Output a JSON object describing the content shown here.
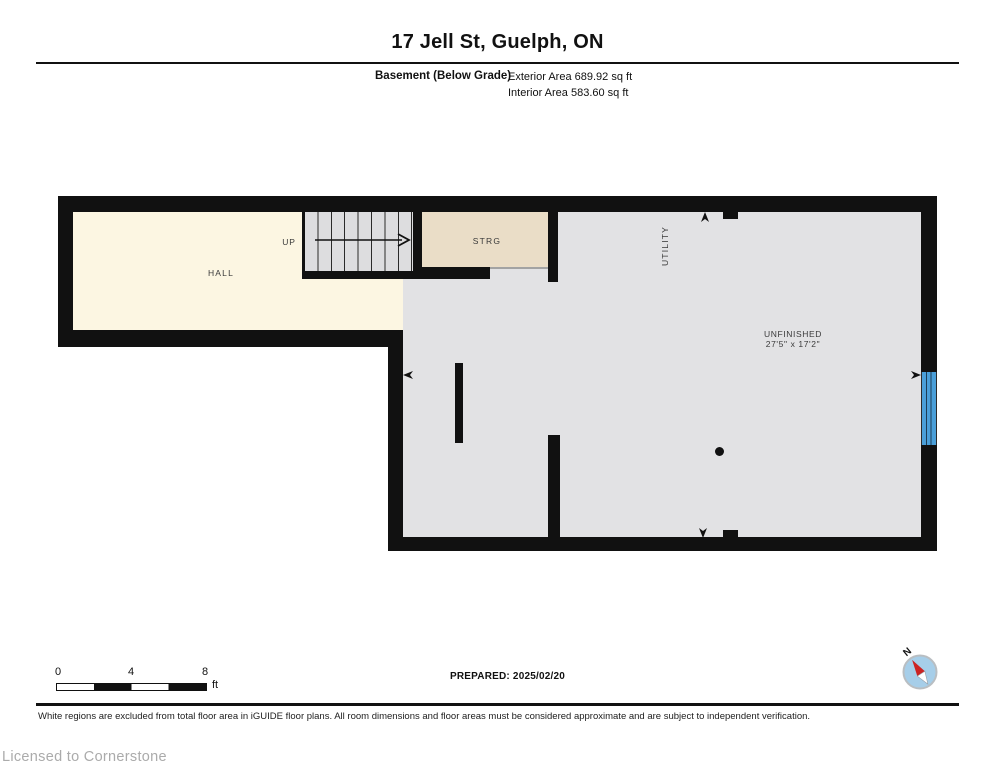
{
  "header": {
    "title": "17 Jell St, Guelph, ON",
    "floor_label": "Basement (Below Grade)",
    "exterior_area": "Exterior Area 689.92 sq ft",
    "interior_area": "Interior Area 583.60 sq ft"
  },
  "plan": {
    "rooms": {
      "hall": "HALL",
      "stairs_direction": "UP",
      "storage": "STRG",
      "utility": "UTILITY",
      "unfinished_name": "UNFINISHED",
      "unfinished_dims": "27'5\" x 17'2\""
    },
    "colors": {
      "wall": "#111111",
      "hall_fill": "#FCF6E2",
      "strg_fill": "#EADDC7",
      "room_fill": "#E2E2E4",
      "stairs_fill": "#DDDDDF",
      "window_blue": "#4A9FD9",
      "compass_blue": "#A6CEE9",
      "needle_red": "#CC2222",
      "license_gray": "#ABABAB"
    }
  },
  "scale_bar": {
    "tick_0": "0",
    "tick_4": "4",
    "tick_8": "8",
    "unit": "ft"
  },
  "prepared": "PREPARED: 2025/02/20",
  "compass": {
    "north_label": "N"
  },
  "footer": {
    "disclaimer": "White regions are excluded from total floor area in iGUIDE floor plans. All room dimensions and floor areas must be considered approximate and are subject to independent verification.",
    "license": "Licensed to Cornerstone"
  }
}
